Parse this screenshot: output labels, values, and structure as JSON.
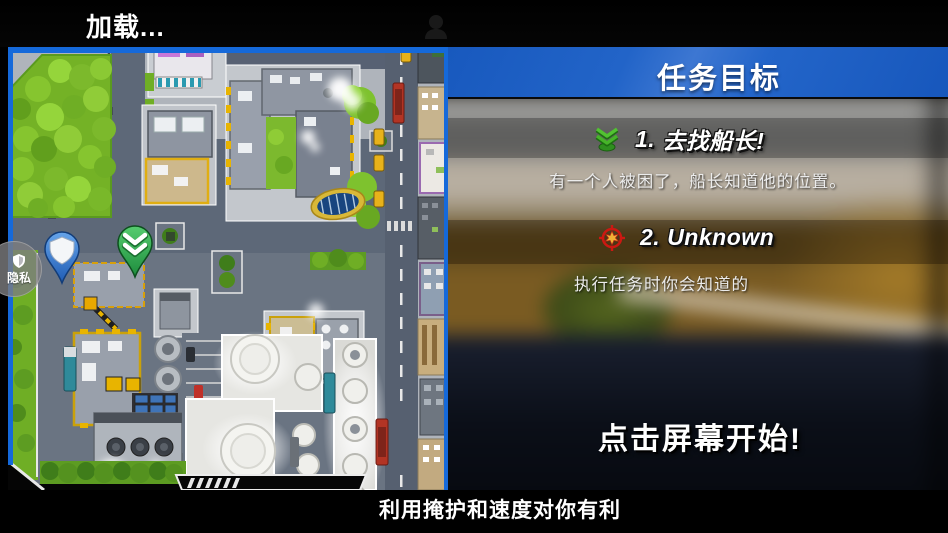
{
  "top_bar": {
    "loading_label": "加载...",
    "profile_icon": "person-silhouette"
  },
  "minimap": {
    "privacy_badge": {
      "label": "隐私",
      "icon": "shield-icon"
    },
    "player_marker": "blue-shield-pin",
    "objective_marker": "green-chevron-pin"
  },
  "mission_panel": {
    "title": "任务目标",
    "objectives": [
      {
        "number": "1.",
        "title": "去找船长!",
        "description": "有一个人被困了，船长知道他的位置。",
        "icon": "green-chevrons-icon"
      },
      {
        "number": "2.",
        "title": "Unknown",
        "description": "执行任务时你会知道的",
        "icon": "red-crosshair-icon"
      }
    ],
    "start_prompt": "点击屏幕开始!"
  },
  "footer": {
    "tip": "利用掩护和速度对你有利"
  },
  "colors": {
    "header_blue": "#2264c8",
    "map_border_blue": "#1569da",
    "park_green": "#74b226",
    "road_gray": "#5d6878",
    "objective_green": "#3fae3a",
    "objective_red": "#cc1f1a"
  }
}
